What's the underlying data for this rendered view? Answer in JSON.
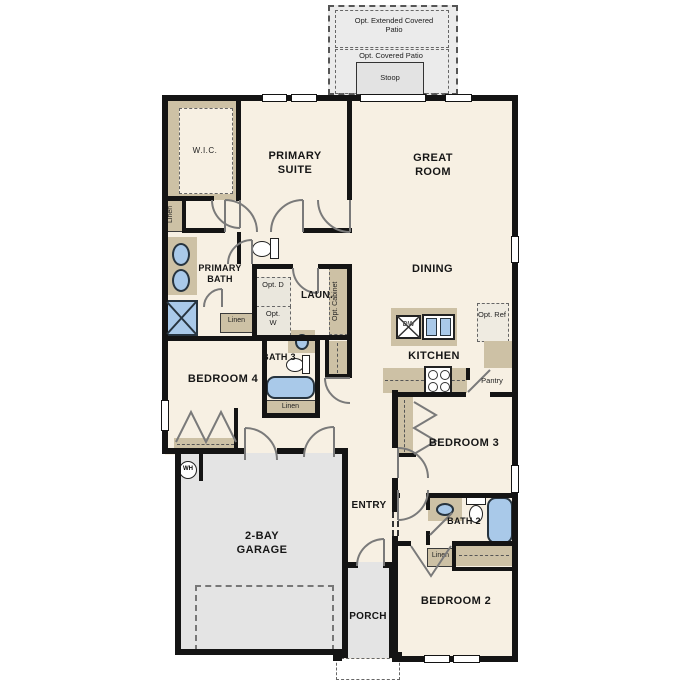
{
  "colors": {
    "wall": "#141414",
    "floor": "#f7f0e3",
    "garage_floor": "#e4e4e4",
    "patio_floor": "#ebebeb",
    "cabinetry_tan": "#cdc1a5",
    "fixture_blue": "#a9c9e9",
    "door_swing_gray": "#7a7a7a"
  },
  "outdoor": {
    "opt_extended_patio": "Opt. Extended Covered Patio",
    "opt_covered_patio": "Opt. Covered Patio",
    "stoop": "Stoop",
    "porch": "PORCH"
  },
  "rooms": {
    "primary_suite": "PRIMARY SUITE",
    "great_room": "GREAT ROOM",
    "dining": "DINING",
    "kitchen": "KITCHEN",
    "primary_bath": "PRIMARY BATH",
    "laundry": "LAUN.",
    "wic": "W.I.C.",
    "bath3": "BATH 3",
    "bedroom4": "BEDROOM 4",
    "garage": "2-BAY GARAGE",
    "entry": "ENTRY",
    "bedroom3": "BEDROOM 3",
    "bath2": "BATH 2",
    "bedroom2": "BEDROOM 2"
  },
  "closets": {
    "linen": "Linen",
    "pantry": "Pantry"
  },
  "equipment": {
    "opt_dryer": "Opt. D",
    "opt_washer": "Opt. W",
    "opt_cabinet": "Opt. Cabinet",
    "opt_ref": "Opt. Ref",
    "dishwasher": "DW",
    "water_heater": "WH"
  }
}
